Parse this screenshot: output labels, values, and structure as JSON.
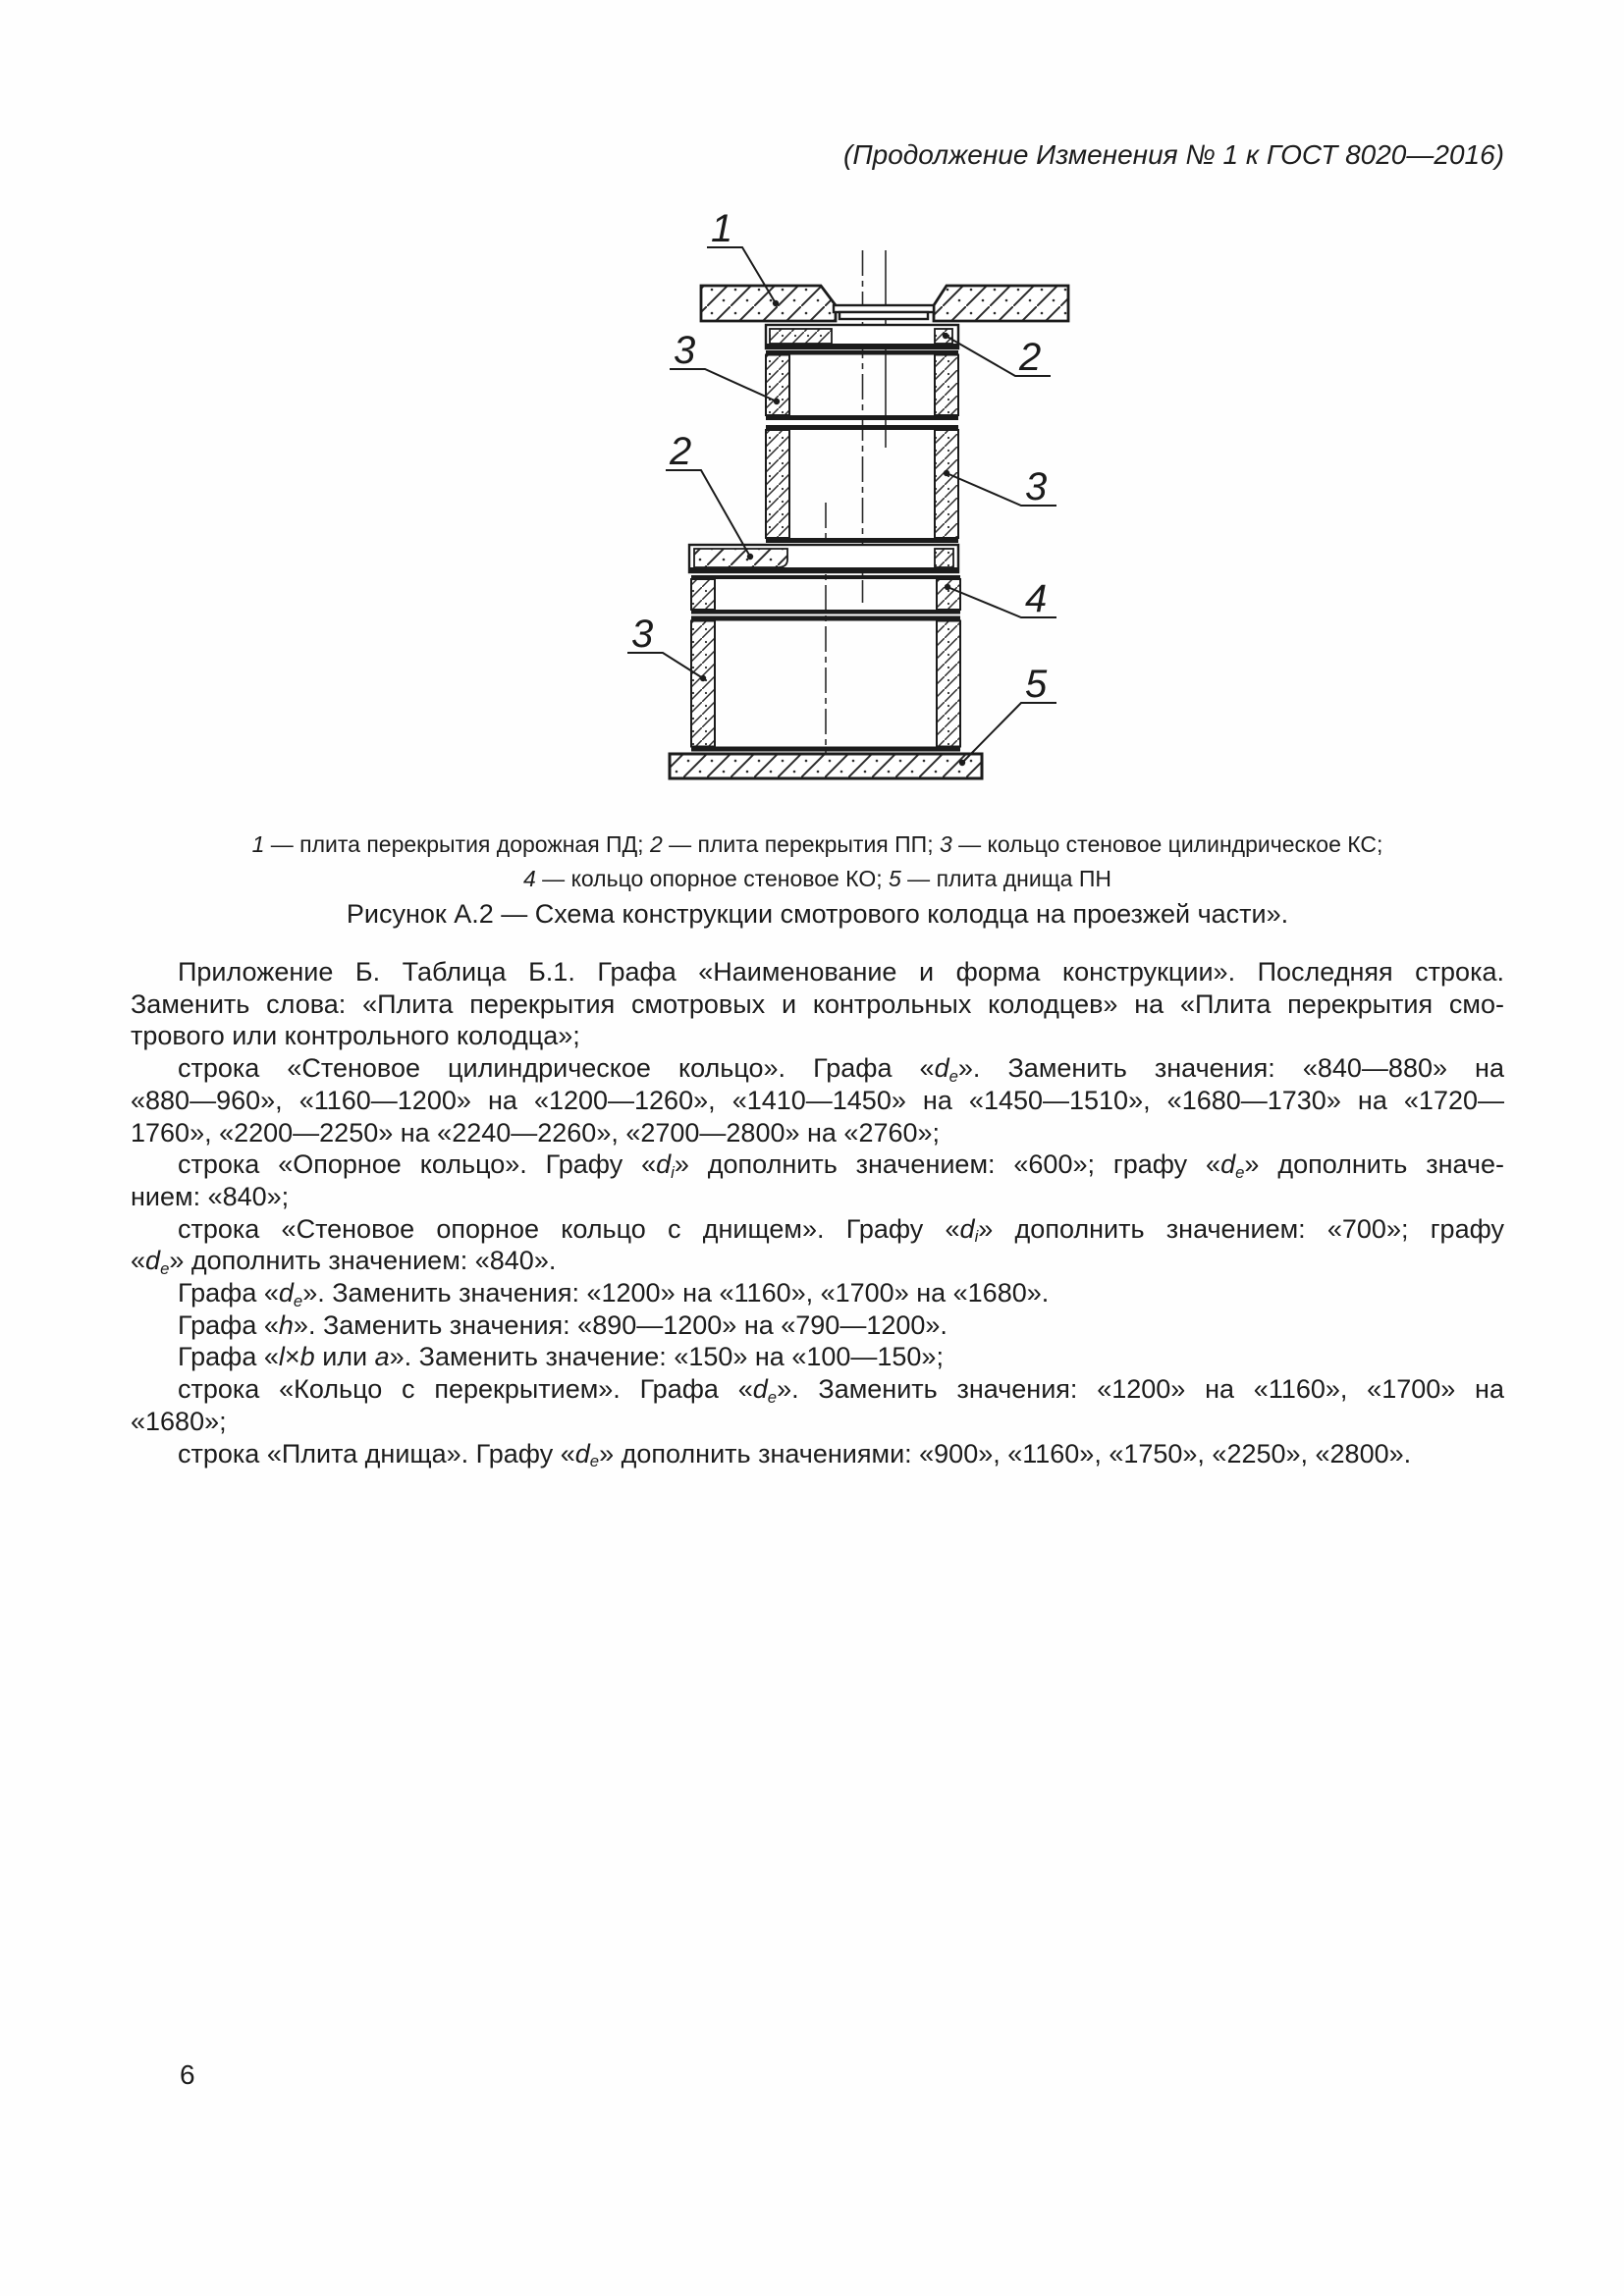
{
  "header": {
    "text": "(Продолжение Изменения № 1 к ГОСТ 8020—2016)"
  },
  "figure": {
    "callouts": [
      {
        "label": "1"
      },
      {
        "label": "3"
      },
      {
        "label": "2"
      },
      {
        "label": "2"
      },
      {
        "label": "3"
      },
      {
        "label": "4"
      },
      {
        "label": "3"
      },
      {
        "label": "5"
      }
    ],
    "caption_lines": [
      {
        "html": "<i>1</i> — плита перекрытия дорожная ПД; <i>2</i> — плита перекрытия ПП; <i>3</i> — кольцо стеновое цилиндрическое КС;"
      },
      {
        "html": "<i>4</i> — кольцо опорное стеновое КО; <i>5</i> — плита днища ПН"
      }
    ],
    "title": "Рисунок А.2 — Схема конструкции смотрового колодца на проезжей части»."
  },
  "body": {
    "lines": [
      {
        "classes": "first",
        "html": "Приложение Б. Таблица Б.1. Графа «Наименование и форма конструкции». Последняя строка."
      },
      {
        "classes": "",
        "html": "Заменить слова: «Плита перекрытия смотровых и контрольных колодцев» на «Плита перекрытия смо-"
      },
      {
        "classes": "last",
        "html": "трового или контрольного колодца»;"
      },
      {
        "classes": "first",
        "html": "строка «Стеновое цилиндрическое кольцо». Графа «<i>d</i><sub>e</sub>». Заменить значения: «840—880» на"
      },
      {
        "classes": "",
        "html": "«880—960», «1160—1200» на «1200—1260», «1410—1450» на «1450—1510», «1680—1730» на «1720—"
      },
      {
        "classes": "last",
        "html": "1760», «2200—2250» на «2240—2260», «2700—2800» на «2760»;"
      },
      {
        "classes": "first",
        "html": "строка «Опорное кольцо». Графу «<i>d</i><sub>i</sub>» дополнить значением: «600»; графу «<i>d</i><sub>e</sub>» дополнить значе-"
      },
      {
        "classes": "last",
        "html": "нием: «840»;"
      },
      {
        "classes": "first",
        "html": "строка «Стеновое опорное кольцо с днищем». Графу «<i>d</i><sub>i</sub>» дополнить значением: «700»; графу"
      },
      {
        "classes": "last",
        "html": "«<i>d</i><sub>e</sub>» дополнить значением: «840»."
      },
      {
        "classes": "first last",
        "html": "Графа «<i>d</i><sub>e</sub>». Заменить значения: «1200» на «1160», «1700» на «1680»."
      },
      {
        "classes": "first last",
        "html": "Графа «<i>h</i>». Заменить значения: «890—1200» на «790—1200»."
      },
      {
        "classes": "first last",
        "html": "Графа «<i>l</i>×<i>b</i> или <i>a</i>». Заменить значение: «150» на «100—150»;"
      },
      {
        "classes": "first",
        "html": "строка «Кольцо с перекрытием». Графа «<i>d</i><sub>e</sub>». Заменить значения: «1200» на «1160», «1700» на"
      },
      {
        "classes": "last",
        "html": "«1680»;"
      },
      {
        "classes": "first last",
        "html": "строка «Плита днища». Графу «<i>d</i><sub>e</sub>» дополнить значениями: «900», «1160», «1750», «2250», «2800»."
      }
    ]
  },
  "footer": {
    "page_number": "6"
  }
}
